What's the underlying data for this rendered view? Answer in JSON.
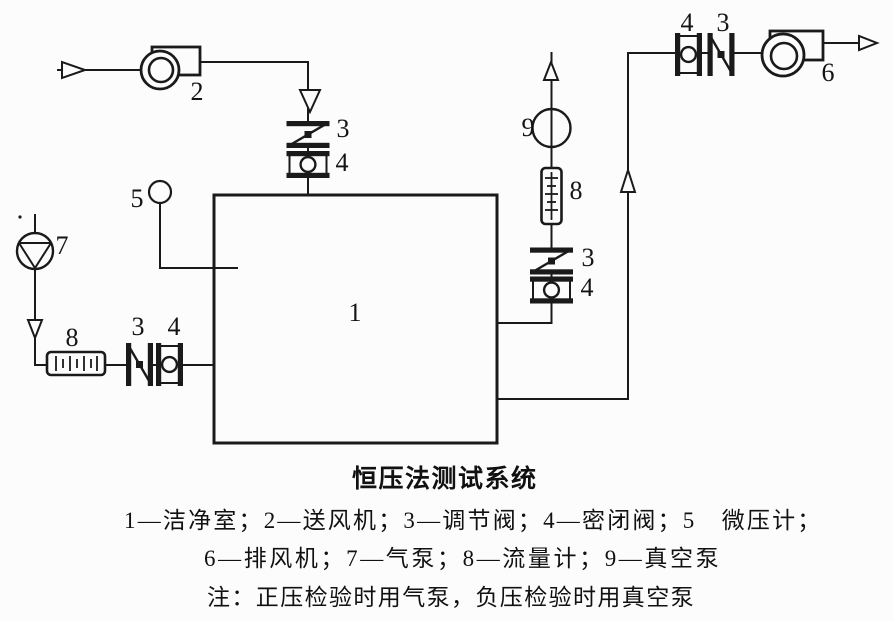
{
  "figure_type": "schematic-diagram",
  "caption": {
    "title": "恒压法测试系统",
    "legend_line1": "1—洁净室；2—送风机；3—调节阀；4—密闭阀；5　微压计；",
    "legend_line2": "6—排风机；7—气泵；8—流量计；9—真空泵",
    "note": "注：正压检验时用气泵，负压检验时用真空泵"
  },
  "labels": {
    "clean_room": "1",
    "supply_fan": "2",
    "supply_reg_valve": "3",
    "supply_seal_valve": "4",
    "micro_manometer": "5",
    "exhaust_fan": "6",
    "air_pump": "7",
    "pump_flow_meter": "8",
    "pump_reg_valve": "3",
    "pump_seal_valve": "4",
    "vac_flow_meter": "8",
    "vac_reg_valve": "3",
    "vac_seal_valve": "4",
    "vacuum_pump": "9",
    "exhaust_seal_valve": "4",
    "exhaust_reg_valve": "3"
  },
  "colors": {
    "ink": "#1a1a1a",
    "paper": "#fcfcfc"
  }
}
